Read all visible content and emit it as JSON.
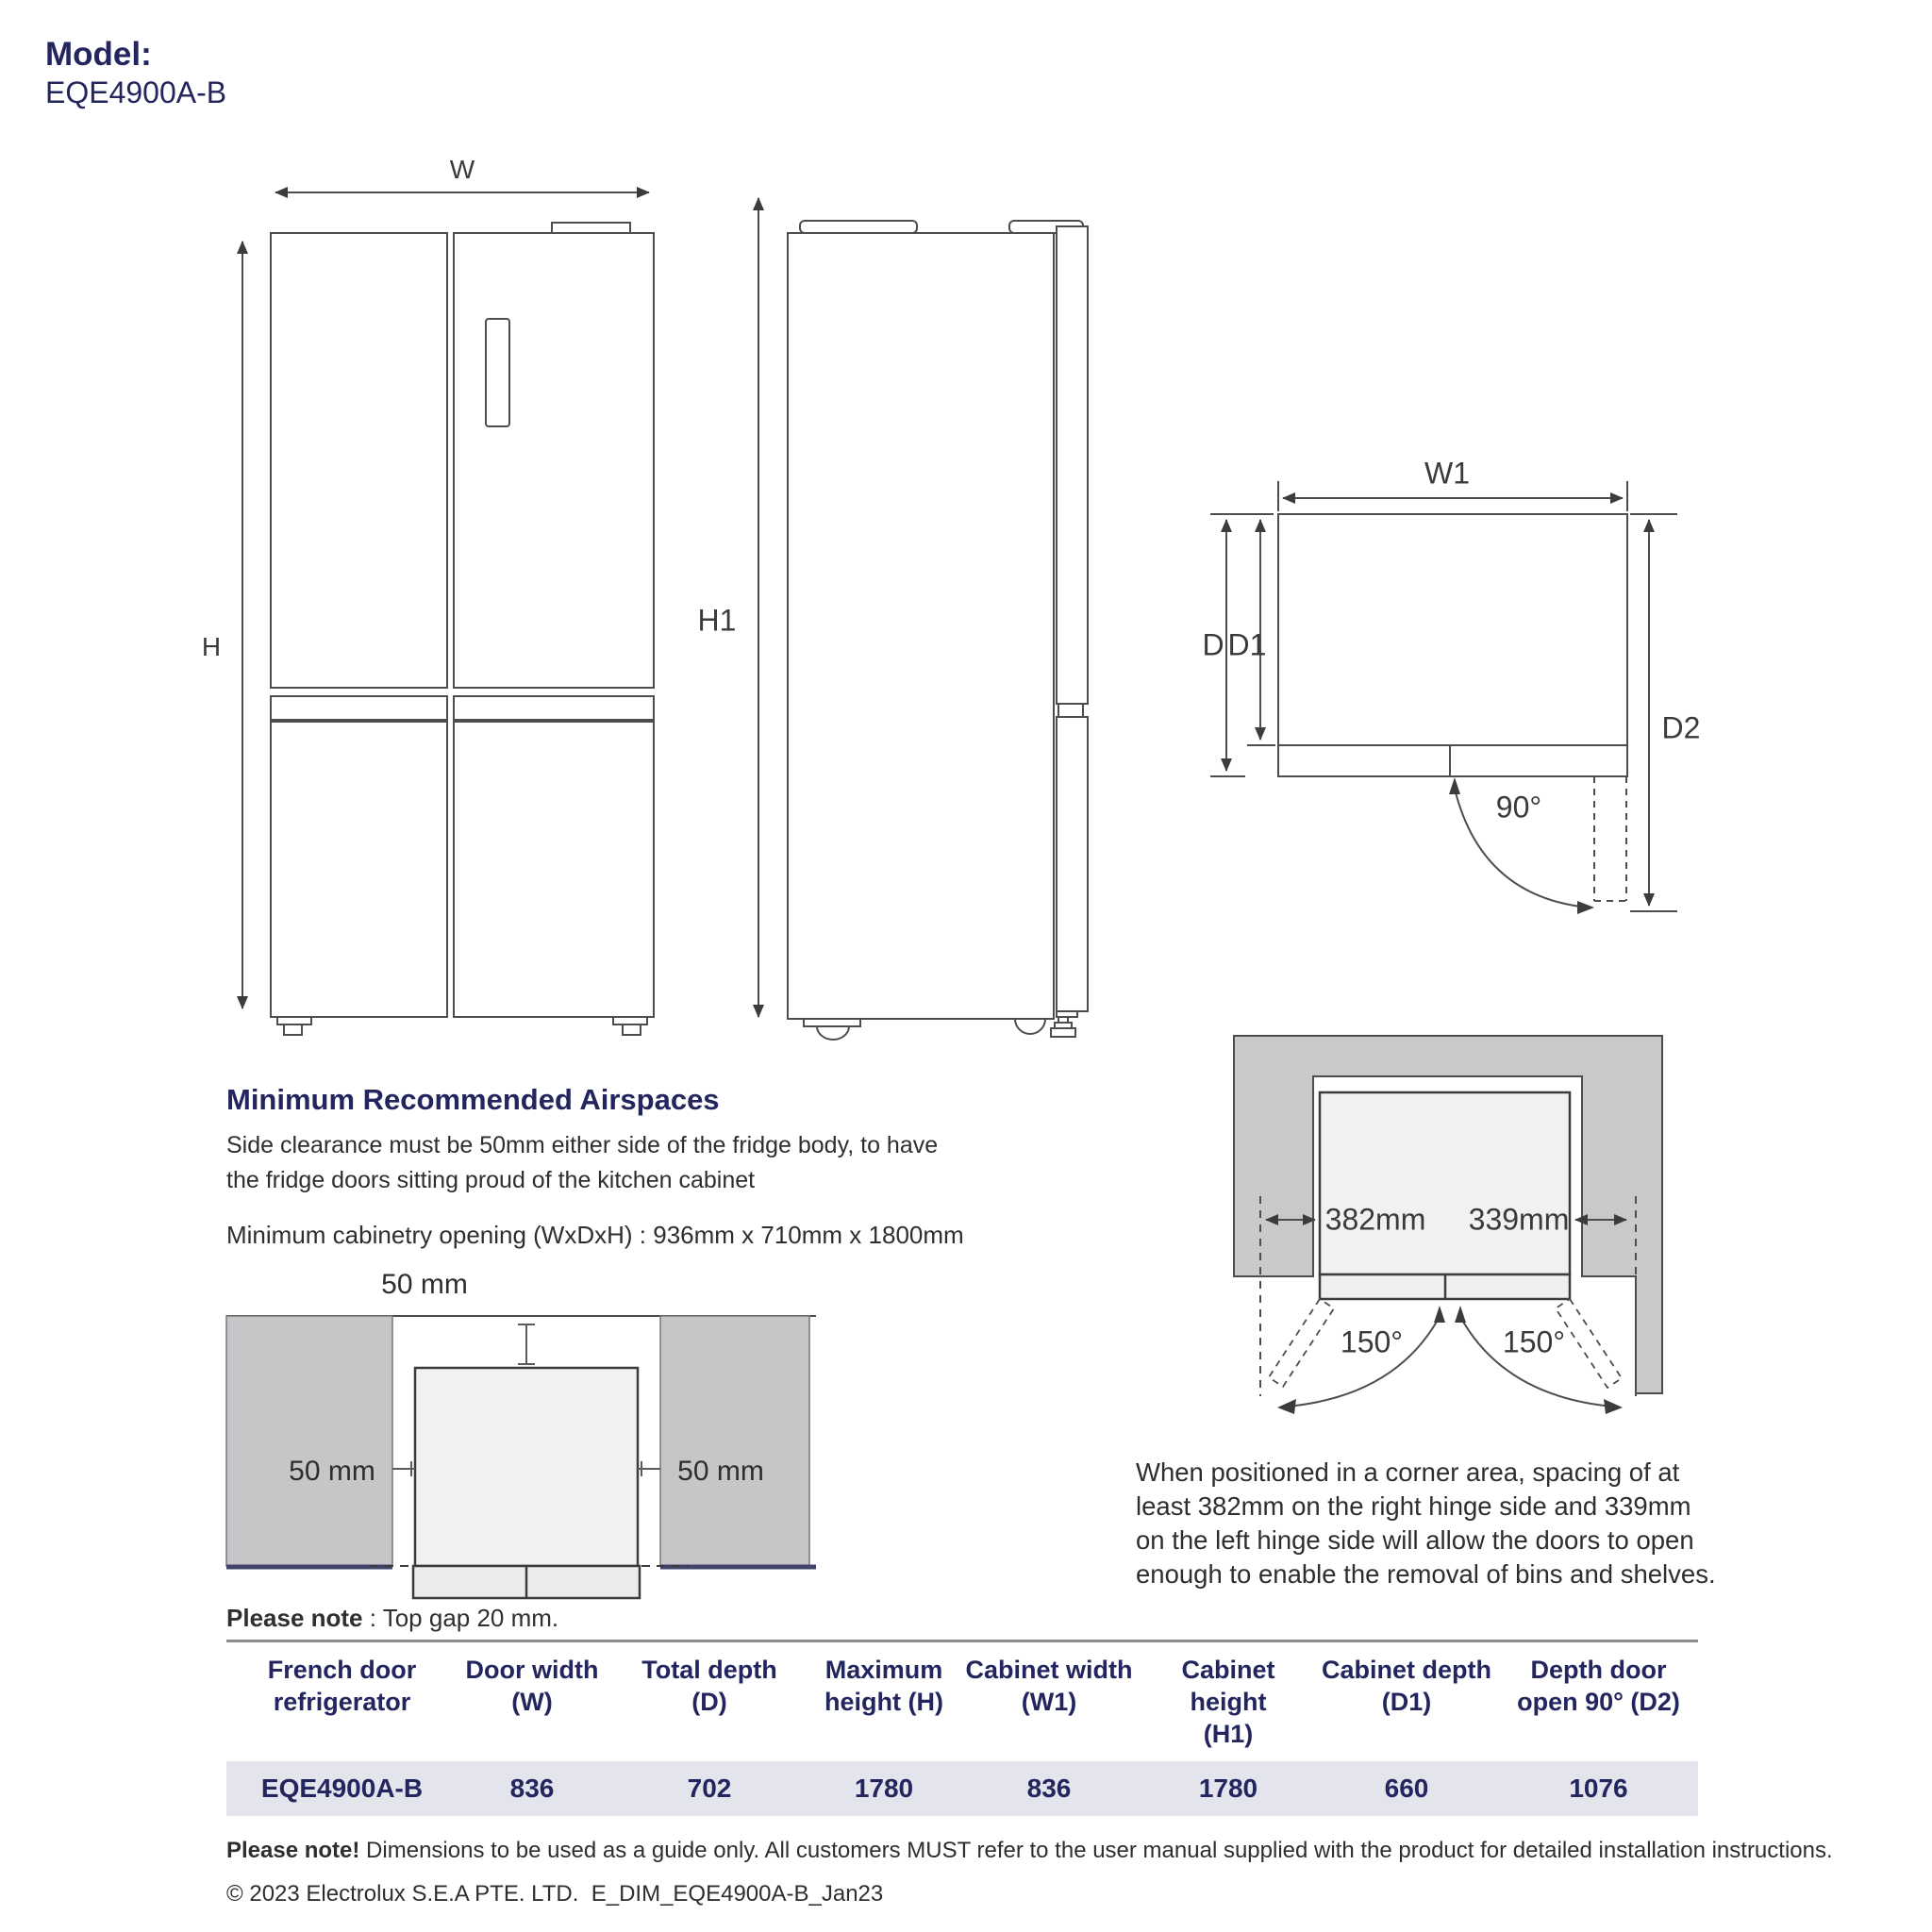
{
  "model": {
    "label": "Model:",
    "number": "EQE4900A-B"
  },
  "front_view": {
    "width_label": "W",
    "height_label": "H"
  },
  "side_view": {
    "height_label": "H1"
  },
  "top_view": {
    "width_label": "W1",
    "depth_label": "D",
    "depth1_label": "D1",
    "depth2_label": "D2",
    "angle_label": "90°"
  },
  "airspaces": {
    "heading": "Minimum Recommended Airspaces",
    "line1": "Side clearance must be 50mm either side of the fridge body, to have",
    "line2": "the fridge doors sitting proud of the kitchen cabinet",
    "cabinetry": "Minimum cabinetry opening (WxDxH) : 936mm x 710mm x 1800mm",
    "gap_top": "50 mm",
    "gap_left": "50 mm",
    "gap_right": "50 mm",
    "note_label": "Please note",
    "note_text": " : Top gap 20 mm."
  },
  "corner": {
    "left_spacing": "382mm",
    "right_spacing": "339mm",
    "left_angle": "150°",
    "right_angle": "150°",
    "note_line1": "When positioned in a corner area, spacing of at",
    "note_line2": "least 382mm on the right hinge side and 339mm",
    "note_line3": "on the left hinge side will allow the doors to open",
    "note_line4": "enough to enable the removal of bins and shelves."
  },
  "table": {
    "headers": [
      {
        "l1": "French door",
        "l2": "refrigerator"
      },
      {
        "l1": "Door width",
        "l2": "(W)"
      },
      {
        "l1": "Total depth",
        "l2": "(D)"
      },
      {
        "l1": "Maximum",
        "l2": "height (H)"
      },
      {
        "l1": "Cabinet width",
        "l2": "(W1)"
      },
      {
        "l1": "Cabinet height",
        "l2": "(H1)"
      },
      {
        "l1": "Cabinet depth",
        "l2": "(D1)"
      },
      {
        "l1": "Depth door",
        "l2": "open 90° (D2)"
      }
    ],
    "row": [
      "EQE4900A-B",
      "836",
      "702",
      "1780",
      "836",
      "1780",
      "660",
      "1076"
    ]
  },
  "footer": {
    "note_label": "Please note!",
    "note_text": " Dimensions to be used as a guide only. All customers MUST refer to the user manual supplied with the product for detailed installation instructions.",
    "copyright": "© 2023 Electrolux S.E.A PTE. LTD.  E_DIM_EQE4900A-B_Jan23"
  },
  "colors": {
    "navy": "#23255e",
    "line": "#4d4d4d",
    "wall_gray": "#c9c9ca",
    "block_gray": "#c6c6c8",
    "fridge_fill": "#f1f1f1",
    "row_bg": "#e4e4ec",
    "navy_line": "#42446e"
  }
}
